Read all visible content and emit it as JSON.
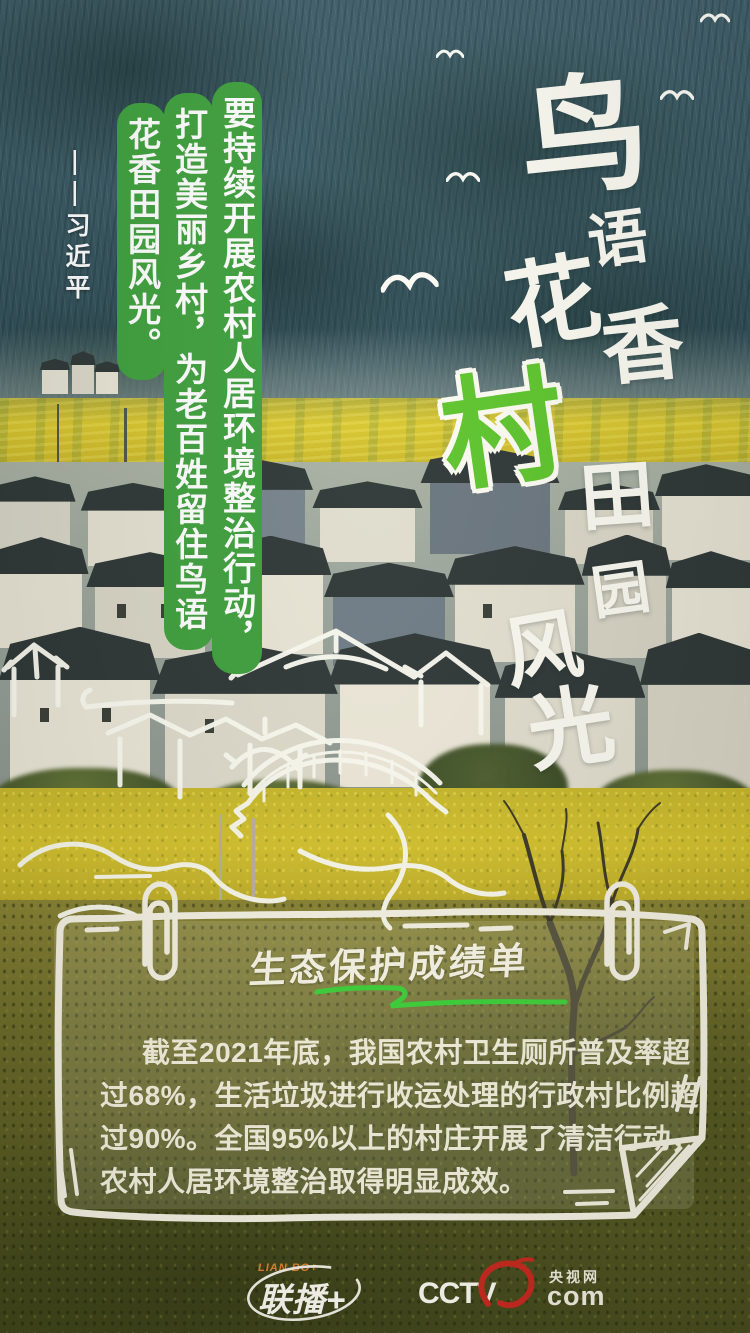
{
  "headline": {
    "chars": [
      "鸟",
      "语",
      "花",
      "香",
      "村",
      "田",
      "园",
      "风",
      "光"
    ]
  },
  "quote": {
    "columns": [
      "要持续开展农村人居环境整治行动，",
      "打造美丽乡村，为老百姓留住鸟语",
      "花香田园风光。"
    ],
    "attribution": "——习近平"
  },
  "card": {
    "title": "生态保护成绩单",
    "body_lines": [
      "截至2021年底，我国农村卫生厕所普及率超",
      "过68%，生活垃圾进行收运处理的行政村比例超",
      "过90%。全国95%以上的村庄开展了清洁行动，",
      "农村人居环境整治取得明显成效。"
    ]
  },
  "footer": {
    "lianbo_en": "LIAN BO+",
    "lianbo_cn": "联播+",
    "cctv_word": "CCTV",
    "cctv_site": "央视网",
    "cctv_domain": "com"
  },
  "colors": {
    "quote_bar_green": "#3fa13d",
    "village_char_green": "#5ec62c",
    "underline_green": "#3ed33a",
    "lianbo_orange": "#e8832e",
    "cctv_red": "#c8281e"
  }
}
